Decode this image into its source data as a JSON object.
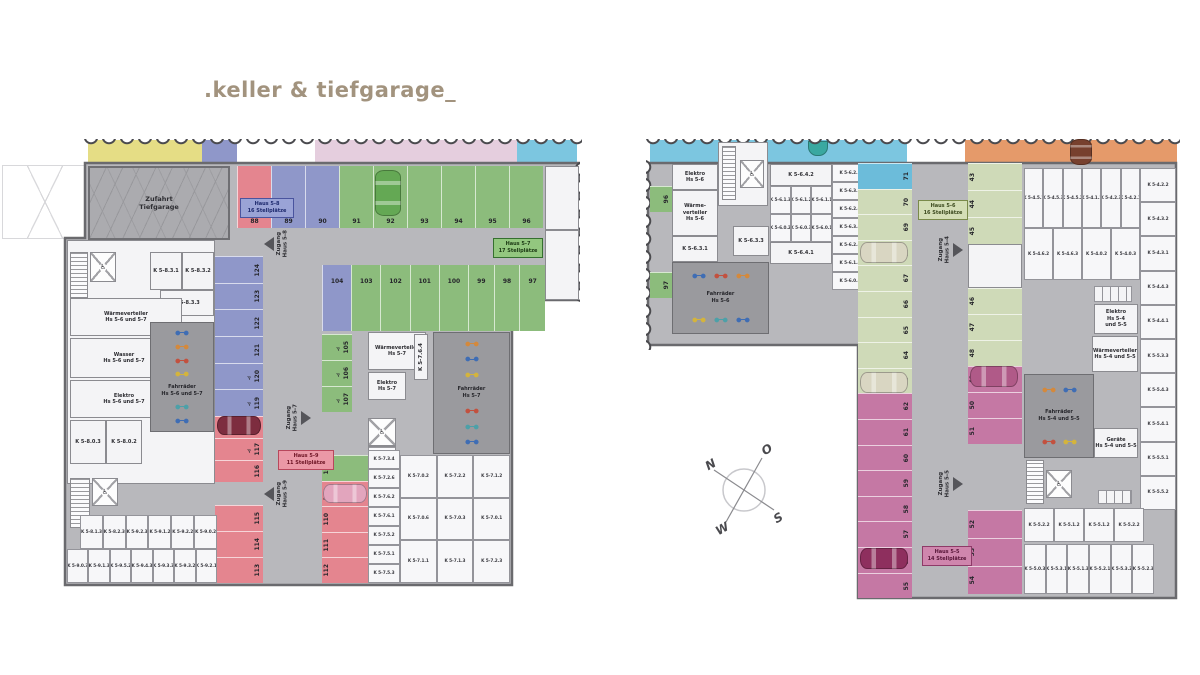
{
  "title": ".keller & tiefgarage_",
  "icons": {
    "wheelchair": "♿"
  },
  "compass": {
    "n": "N",
    "o": "O",
    "s": "S",
    "w": "W"
  },
  "colors": {
    "floor": "#b8b8bc",
    "wall": "#6a6a6e",
    "title": "#a2937e",
    "haus57_green": "#8cbc7c",
    "haus58_blue": "#8f97c9",
    "haus59_red": "#e4858f",
    "haus56_sage": "#cfdab8",
    "haus55_magenta": "#c578a4",
    "strip_yellow": "#e5dd85",
    "strip_pink": "#e5cede",
    "strip_cyan": "#7cc6e0",
    "strip_orange": "#e59a6a"
  },
  "left": {
    "rooms": {
      "zufahrt": {
        "l1": "Zufahrt",
        "l2": "Tiefgarage"
      },
      "waerme67": {
        "l1": "Wärmeverteiler",
        "l2": "Hs 5-6 und 5-7"
      },
      "wasser67": {
        "l1": "Wasser",
        "l2": "Hs 5-6 und 5-7"
      },
      "elektro67": {
        "l1": "Elektro",
        "l2": "Hs 5-6 und 5-7"
      },
      "fahrrad67": {
        "l1": "Fahrräder",
        "l2": "Hs 5-6 und 5-7"
      },
      "waerme7": {
        "l1": "Wärmeverteiler",
        "l2": "Hs 5-7"
      },
      "elektro7": {
        "l1": "Elektro",
        "l2": "Hs 5-7"
      },
      "fahrrad7": {
        "l1": "Fahrräder",
        "l2": "Hs 5-7"
      },
      "k831": "K 5-8.3.1",
      "k832": "K 5-8.3.2",
      "k833": "K 5-8.3.3",
      "k803": "K 5-8.0.3",
      "k802": "K 5-8.0.2",
      "k764": "K 5-7.6.4"
    },
    "badge58": {
      "l1": "Haus 5-8",
      "l2": "16 Stellplätze"
    },
    "badge57": {
      "l1": "Haus 5-7",
      "l2": "17 Stellplätze"
    },
    "badge59": {
      "l1": "Haus 5-9",
      "l2": "11 Stellplätze"
    },
    "zugang58": "Zugang\nHaus 5-8",
    "zugang57": "Zugang\nHaus 5-7",
    "zugang59": "Zugang\nHaus 5-9",
    "spaces": {
      "row_top": [
        {
          "n": "88",
          "c": "sp-red"
        },
        {
          "n": "89",
          "c": "sp-blue"
        },
        {
          "n": "90",
          "c": "sp-blue"
        },
        {
          "n": "91",
          "c": "sp-green"
        },
        {
          "n": "92",
          "c": "sp-green"
        },
        {
          "n": "93",
          "c": "sp-green"
        },
        {
          "n": "94",
          "c": "sp-green"
        },
        {
          "n": "95",
          "c": "sp-green"
        },
        {
          "n": "96",
          "c": "sp-green"
        }
      ],
      "row2a": [
        {
          "n": "104",
          "c": "sp-blue"
        },
        {
          "n": "103",
          "c": "sp-green"
        },
        {
          "n": "102",
          "c": "sp-green"
        },
        {
          "n": "101",
          "c": "sp-green"
        },
        {
          "n": "100",
          "c": "sp-green"
        }
      ],
      "row2b": [
        {
          "n": "99",
          "c": "sp-green"
        },
        {
          "n": "98",
          "c": "sp-green"
        },
        {
          "n": "97",
          "c": "sp-green"
        }
      ],
      "col_blue": [
        {
          "n": "124",
          "c": "sp-blue"
        },
        {
          "n": "123",
          "c": "sp-blue"
        },
        {
          "n": "122",
          "c": "sp-blue"
        },
        {
          "n": "121",
          "c": "sp-blue"
        },
        {
          "n": "120",
          "c": "sp-blue",
          "icon": "♿"
        },
        {
          "n": "119",
          "c": "sp-blue",
          "icon": "♿"
        }
      ],
      "col_red_upper": [
        {
          "n": "118",
          "c": "sp-red"
        },
        {
          "n": "117",
          "c": "sp-red",
          "icon": "♿"
        },
        {
          "n": "116",
          "c": "sp-red"
        }
      ],
      "col_red_lower": [
        {
          "n": "115",
          "c": "sp-red"
        },
        {
          "n": "114",
          "c": "sp-red"
        },
        {
          "n": "113",
          "c": "sp-red"
        }
      ],
      "col_green": [
        {
          "n": "105",
          "c": "sp-green",
          "icon": "♿"
        },
        {
          "n": "106",
          "c": "sp-green",
          "icon": "♿"
        },
        {
          "n": "107",
          "c": "sp-green",
          "icon": "♿"
        }
      ],
      "col_mixed": [
        {
          "n": "108",
          "c": "sp-green"
        },
        {
          "n": "109",
          "c": "sp-red"
        },
        {
          "n": "110",
          "c": "sp-red"
        },
        {
          "n": "111",
          "c": "sp-red"
        },
        {
          "n": "112",
          "c": "sp-red"
        }
      ]
    },
    "storage": {
      "row1": [
        "K 5-8.1.3",
        "K 5-8.2.3",
        "K 5-9.2.3",
        "K 5-9.1.2",
        "K 5-9.2.2",
        "K 5-9.0.2"
      ],
      "row2": [
        "K 5-9.0.3",
        "K 5-9.1.3",
        "K 5-9.5.2",
        "K 5-9.4.3",
        "K 5-9.3.3",
        "K 5-9.3.2",
        "K 5-9.2.1"
      ],
      "col7": [
        "K 5-7.3.4",
        "K 5-7.2.6",
        "K 5-7.6.2",
        "K 5-7.6.1",
        "K 5-7.5.2",
        "K 5-7.5.1",
        "K 5-7.5.3"
      ],
      "grid7": [
        "K 5-7.0.2",
        "K 5-7.2.2",
        "K 5-7.1.2",
        "K 5-7.0.6",
        "K 5-7.0.3",
        "K 5-7.0.1",
        "K 5-7.1.1",
        "K 5-7.1.3",
        "K 5-7.2.3"
      ]
    }
  },
  "right": {
    "rooms": {
      "elektro6": {
        "l1": "Elektro",
        "l2": "Hs 5-6"
      },
      "waerme6": {
        "l1": "Wärme-",
        "l2": "verteiler",
        "l3": "Hs 5-6"
      },
      "fahrrad6": {
        "l1": "Fahrräder",
        "l2": "Hs 5-6"
      },
      "k631": "K 5-6.3.1",
      "k633": "K 5-6.3.3",
      "k642": "K 5-6.4.2",
      "k641": "K 5-6.4.1",
      "elektro45": {
        "l1": "Elektro",
        "l2": "Hs 5-4",
        "l3": "und 5-5"
      },
      "waerme45": {
        "l1": "Wärmeverteiler",
        "l2": "Hs 5-4 und 5-5"
      },
      "fahrrad45": {
        "l1": "Fahrräder",
        "l2": "Hs 5-4 und 5-5"
      },
      "geraete45": {
        "l1": "Geräte",
        "l2": "Hs 5-4 und 5-5"
      }
    },
    "badge56": {
      "l1": "Haus 5-6",
      "l2": "16 Stellplätze"
    },
    "badge55": {
      "l1": "Haus 5-5",
      "l2": "14 Stellplätze"
    },
    "zugang54": "Zugang\nHaus 5-4",
    "zugang55": "Zugang\nHaus 5-5",
    "edge96": "96",
    "edge97": "97",
    "spaces": {
      "col_left": [
        {
          "n": "71",
          "c": "sp-cyan"
        },
        {
          "n": "70",
          "c": "sp-sage"
        },
        {
          "n": "69",
          "c": "sp-sage"
        },
        {
          "n": "68",
          "c": "sp-sage"
        },
        {
          "n": "67",
          "c": "sp-sage"
        },
        {
          "n": "66",
          "c": "sp-sage"
        },
        {
          "n": "65",
          "c": "sp-sage"
        },
        {
          "n": "64",
          "c": "sp-sage"
        },
        {
          "n": "63",
          "c": "sp-sage"
        },
        {
          "n": "62",
          "c": "sp-mag"
        },
        {
          "n": "61",
          "c": "sp-mag"
        },
        {
          "n": "60",
          "c": "sp-mag"
        },
        {
          "n": "59",
          "c": "sp-mag"
        },
        {
          "n": "58",
          "c": "sp-mag"
        },
        {
          "n": "57",
          "c": "sp-mag"
        },
        {
          "n": "56",
          "c": "sp-mag"
        },
        {
          "n": "55",
          "c": "sp-mag"
        }
      ],
      "col_right_top": [
        {
          "n": "43",
          "c": "sp-sage"
        },
        {
          "n": "44",
          "c": "sp-sage"
        },
        {
          "n": "45",
          "c": "sp-sage"
        }
      ],
      "col_right_mid": [
        {
          "n": "46",
          "c": "sp-sage"
        },
        {
          "n": "47",
          "c": "sp-sage"
        },
        {
          "n": "48",
          "c": "sp-sage"
        },
        {
          "n": "49",
          "c": "sp-mag"
        },
        {
          "n": "50",
          "c": "sp-mag"
        },
        {
          "n": "51",
          "c": "sp-mag"
        }
      ],
      "col_right_bottom": [
        {
          "n": "52",
          "c": "sp-mag"
        },
        {
          "n": "53",
          "c": "sp-mag"
        },
        {
          "n": "54",
          "c": "sp-mag"
        }
      ]
    },
    "storage": {
      "grid6_r1": [
        "K 5-6.1.3",
        "K 5-6.1.2",
        "K 5-6.1.1"
      ],
      "grid6_r2": [
        "K 5-6.0.2",
        "K 5-6.0.3",
        "K 5-6.0.1"
      ],
      "col6": [
        "K 5-6.2.1",
        "K 5-6.3.2",
        "K 5-6.2.6",
        "K 5-6.3.4",
        "K 5-6.2.4",
        "K 5-6.1.4",
        "K 5-6.0.4"
      ],
      "grid4_r1": [
        "K 5-4.5.1",
        "K 5-4.5.3",
        "K 5-4.5.2",
        "K 5-4.1.1",
        "K 5-4.2.3",
        "K 5-4.2.1"
      ],
      "grid4_r2": [
        "K 5-4.6.2",
        "K 5-4.6.3",
        "K 5-4.0.2",
        "K 5-4.0.3"
      ],
      "edge45": [
        "K 5-4.2.2",
        "K 5-4.3.2",
        "K 5-4.3.1",
        "K 5-4.4.3",
        "K 5-4.4.1",
        "K 5-5.3.3",
        "K 5-5.4.3",
        "K 5-5.4.1",
        "K 5-5.5.1",
        "K 5-5.5.2"
      ],
      "grid5_r1": [
        "K 5-5.2.2",
        "K 5-5.1.2",
        "K 5-5.1.2",
        "K 5-5.2.2"
      ],
      "grid5_r2": [
        "K 5-5.0.3",
        "K 5-5.3.1",
        "K 5-5.1.3",
        "K 5-5.2.1",
        "K 5-5.3.2",
        "K 5-5.2.3"
      ]
    }
  }
}
